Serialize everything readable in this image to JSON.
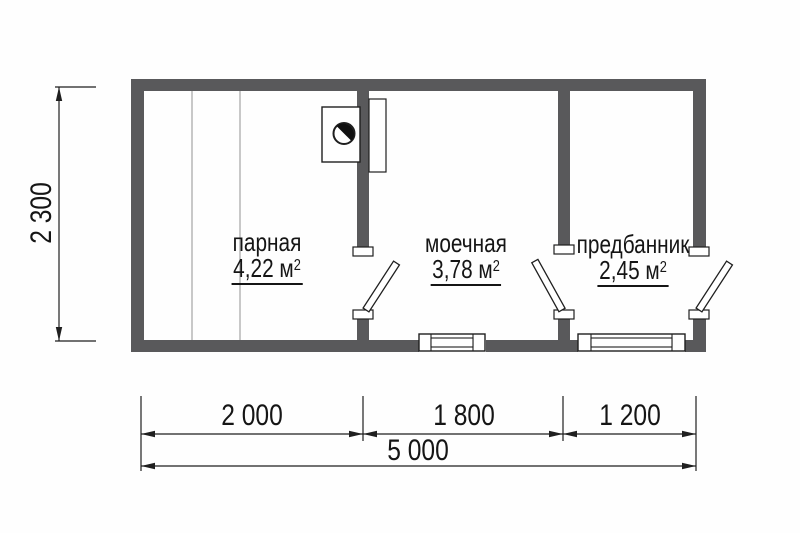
{
  "floor_plan": {
    "rooms": [
      {
        "name": "парная",
        "area": "4,22 м",
        "area_sup": "2"
      },
      {
        "name": "моечная",
        "area": "3,78 м",
        "area_sup": "2"
      },
      {
        "name": "предбанник",
        "area": "2,45 м",
        "area_sup": "2"
      }
    ],
    "dimensions": {
      "vertical_total": "2 300",
      "bottom_segments": [
        "2 000",
        "1 800",
        "1 200"
      ],
      "bottom_total": "5 000"
    },
    "colors": {
      "wall": "#59595b",
      "line": "#1f1f1f",
      "bench_line": "#ababab",
      "background": "#fefefe"
    }
  }
}
